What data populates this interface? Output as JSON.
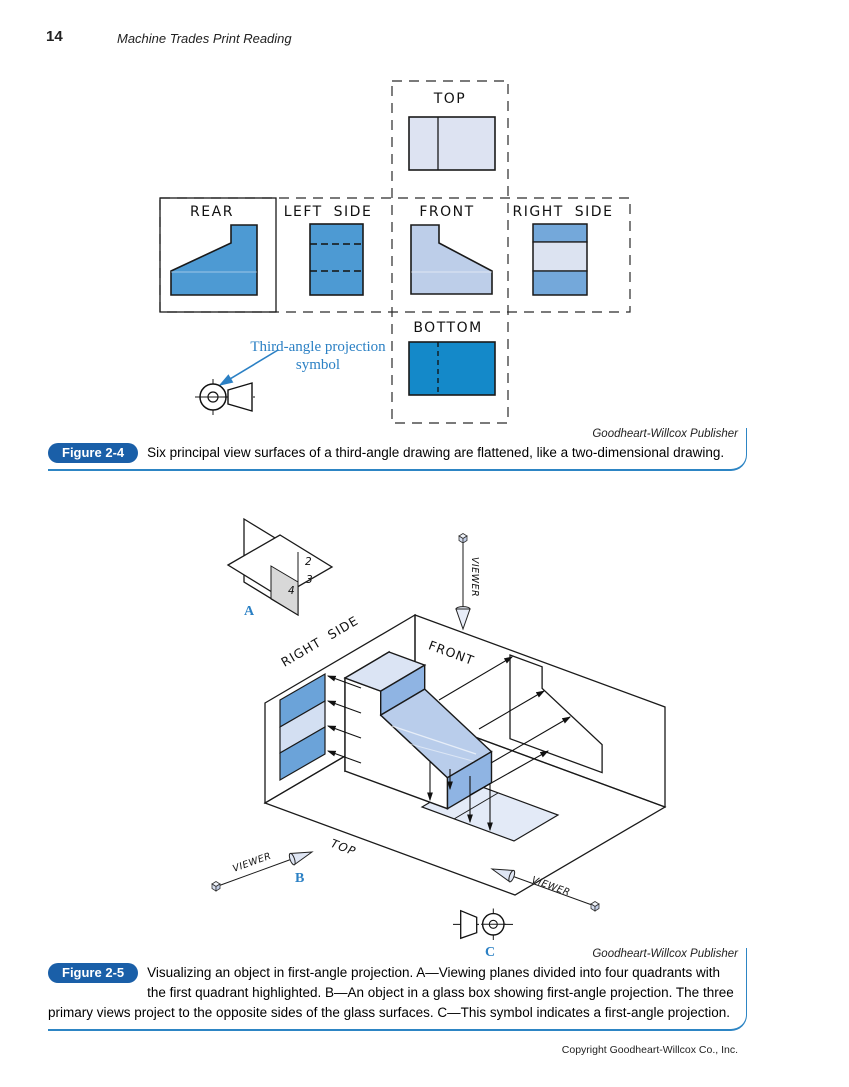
{
  "page": {
    "number": "14",
    "running_title": "Machine Trades Print Reading",
    "copyright": "Copyright Goodheart-Willcox Co., Inc."
  },
  "figure4": {
    "badge": "Figure 2-4",
    "caption": "Six principal view surfaces of a third-angle drawing are flattened, like a two-dimensional drawing.",
    "credit": "Goodheart-Willcox Publisher",
    "views": {
      "top": "TOP",
      "rear": "REAR",
      "left_side": "LEFT SIDE",
      "front": "FRONT",
      "right_side": "RIGHT SIDE",
      "bottom": "BOTTOM"
    },
    "annotation": {
      "line1": "Third-angle projection",
      "line2": "symbol"
    },
    "colors": {
      "rear": "#4d9ad3",
      "left_side": "#4d9ad3",
      "front": "#bdcee9",
      "top_view": "#dde3f2",
      "right_top": "#74a8da",
      "right_mid": "#dce3f1",
      "right_bottom": "#74a8da",
      "bottom_view": "#1489c9",
      "annotation_blue": "#2b80c4"
    }
  },
  "figure5": {
    "badge": "Figure 2-5",
    "caption": "Visualizing an object in first-angle projection. A—Viewing planes divided into four quadrants with the first quadrant highlighted. B—An object in a glass box showing first-angle projection. The three primary views project to the opposite sides of the glass surfaces. C—This symbol indicates a first-angle projection.",
    "credit": "Goodheart-Willcox Publisher",
    "labels": {
      "a": "A",
      "b": "B",
      "c": "C",
      "viewer": "VIEWER",
      "right_side": "RIGHT SIDE",
      "front": "FRONT",
      "top": "TOP",
      "q2": "2",
      "q3": "3",
      "q4": "4"
    },
    "colors": {
      "quadrant_gray": "#d8d8d8",
      "object_light": "#dbe4f4",
      "object_mid": "#b9cdeb",
      "object_dark": "#8fb4e3",
      "band": "#6ba3d9",
      "band_light": "#d3dff2",
      "floor_view": "#e3eaf7",
      "label_blue": "#2b80c4"
    }
  }
}
